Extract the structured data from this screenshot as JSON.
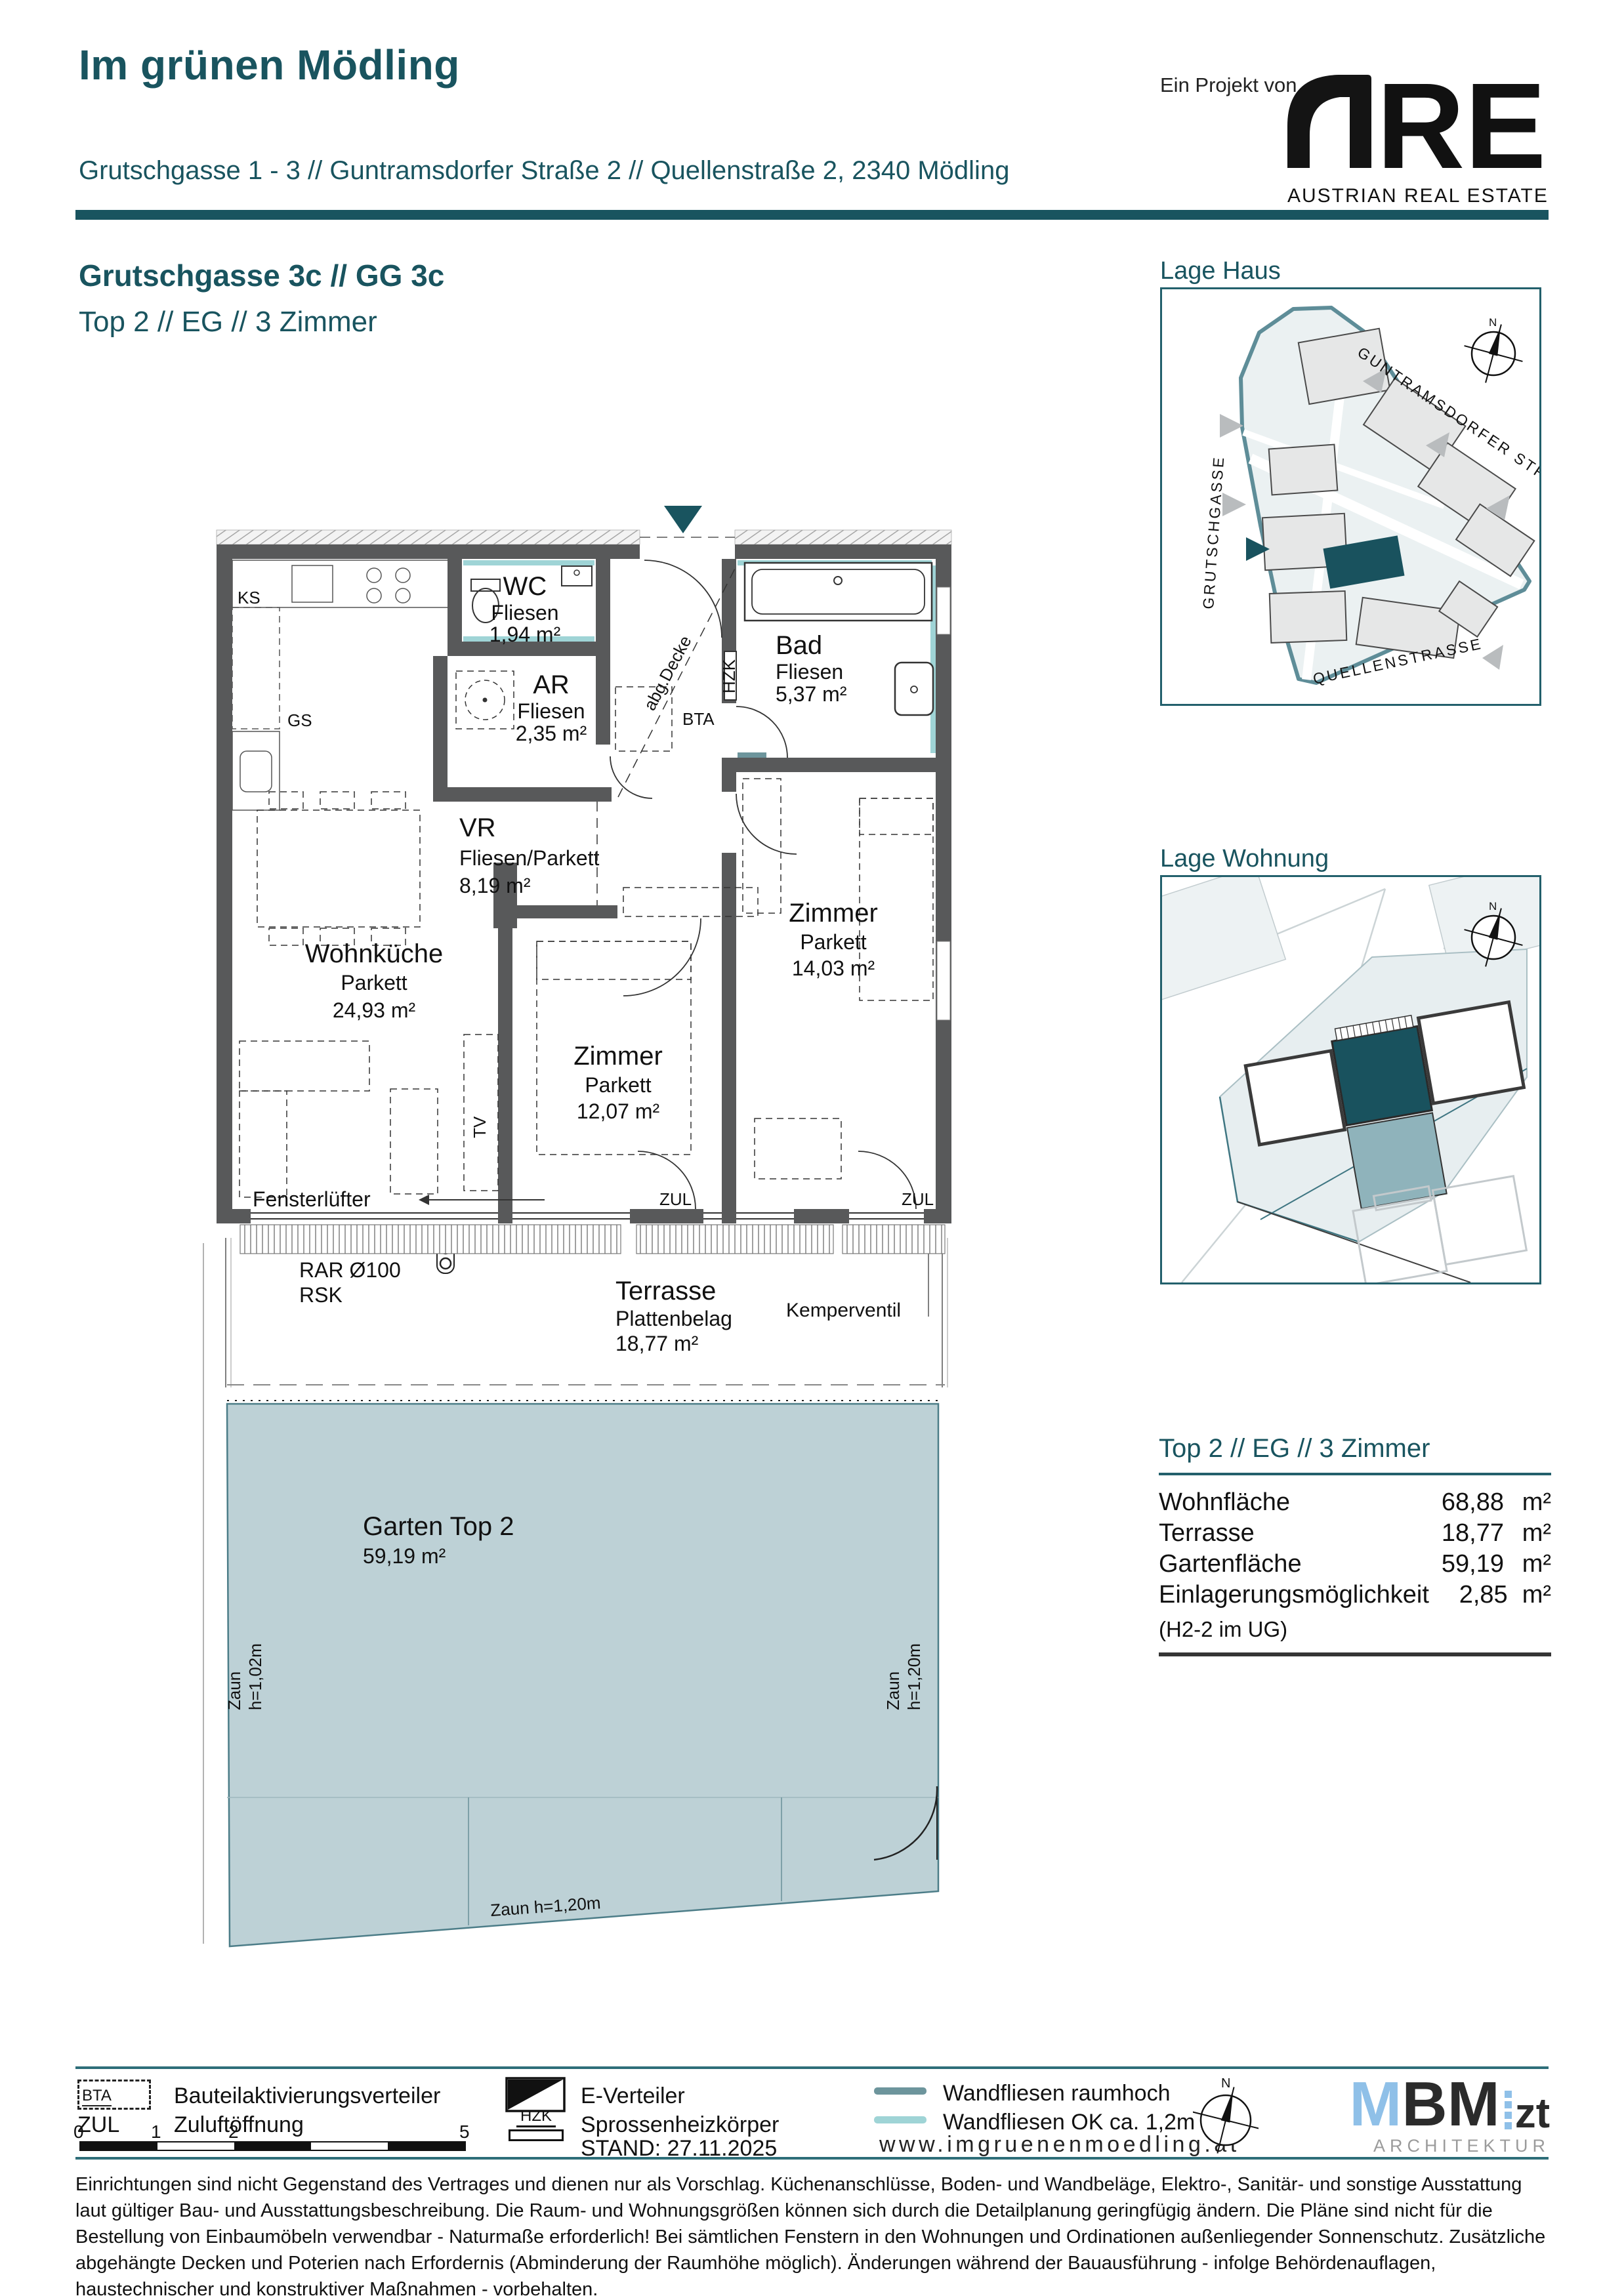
{
  "header": {
    "title": "Im grünen Mödling",
    "address": "Grutschgasse 1 - 3 // Guntramsdorfer Straße 2 // Quellenstraße 2, 2340 Mödling",
    "project_note": "Ein Projekt von",
    "are_logo": {
      "re": "RE",
      "subtitle": "AUSTRIAN REAL ESTATE",
      "green": "#a5c939"
    }
  },
  "section": {
    "building": "Grutschgasse 3c // GG 3c",
    "unit": "Top 2 // EG // 3 Zimmer"
  },
  "plan": {
    "rooms": {
      "wc": {
        "name": "WC",
        "finish": "Fliesen",
        "area": "1,94 m²"
      },
      "ar": {
        "name": "AR",
        "finish": "Fliesen",
        "area": "2,35 m²"
      },
      "bad": {
        "name": "Bad",
        "finish": "Fliesen",
        "area": "5,37 m²"
      },
      "vr": {
        "name": "VR",
        "finish": "Fliesen/Parkett",
        "area": "8,19 m²"
      },
      "wohnkueche": {
        "name": "Wohnküche",
        "finish": "Parkett",
        "area": "24,93 m²"
      },
      "zimmer1": {
        "name": "Zimmer",
        "finish": "Parkett",
        "area": "12,07 m²"
      },
      "zimmer2": {
        "name": "Zimmer",
        "finish": "Parkett",
        "area": "14,03 m²"
      },
      "terrasse": {
        "name": "Terrasse",
        "finish": "Plattenbelag",
        "area": "18,77 m²"
      },
      "garten": {
        "name": "Garten Top 2",
        "area": "59,19 m²"
      }
    },
    "tags": {
      "ks": "KS",
      "gs": "GS",
      "bta": "BTA",
      "hzk": "HZK",
      "tv": "TV",
      "zul1": "ZUL",
      "zul2": "ZUL",
      "abg_decke": "abg.Decke"
    },
    "annotations": {
      "fensterluefter": "Fensterlüfter",
      "rar": "RAR Ø100",
      "rsk": "RSK",
      "kemperventil": "Kemperventil",
      "zaun_left": "Zaun",
      "zaun_left_h": "h=1,02m",
      "zaun_right": "Zaun",
      "zaun_right_h": "h=1,20m",
      "zaun_bottom": "Zaun h=1,20m"
    },
    "colors": {
      "wall": "#58595a",
      "tile_light": "#9fd4d6",
      "tile_dark": "#6d959c",
      "garden_fill": "#bdd1d6",
      "accent": "#19545f"
    }
  },
  "maps": {
    "lage_haus": {
      "title": "Lage Haus",
      "north": "N",
      "streets": {
        "guntramsdorfer": "GUNTRAMSDORFER STRASSE",
        "grutschgasse": "GRUTSCHGASSE",
        "quellenstrasse": "QUELLENSTRASSE"
      }
    },
    "lage_wohnung": {
      "title": "Lage Wohnung",
      "north": "N"
    }
  },
  "summary": {
    "title": "Top 2 // EG // 3 Zimmer",
    "rows": [
      {
        "label": "Wohnfläche",
        "value": "68,88",
        "unit": "m²"
      },
      {
        "label": "Terrasse",
        "value": "18,77",
        "unit": "m²"
      },
      {
        "label": "Gartenfläche",
        "value": "59,19",
        "unit": "m²"
      },
      {
        "label": "Einlagerungsmöglichkeit",
        "value": "2,85",
        "unit": "m²"
      }
    ],
    "note": "(H2-2 im UG)"
  },
  "footer": {
    "legend": {
      "bta_abbr": "BTA",
      "bta": "Bauteilaktivierungsverteiler",
      "zul_abbr": "ZUL",
      "zul": "Zuluftöffnung",
      "e_verteiler": "E-Verteiler",
      "hzk_abbr": "HZK",
      "hzk": "Sprossenheizkörper",
      "tiles_full": "Wandfliesen raumhoch",
      "tiles_half": "Wandfliesen OK ca. 1,2m"
    },
    "scale": {
      "t0": "0",
      "t1": "1",
      "t2": "2",
      "t5": "5"
    },
    "stand": "STAND: 27.11.2025",
    "website": "www.imgruenenmoedling.at",
    "north": "N",
    "mbm": {
      "m": "M",
      "bm": "BM",
      "zt": "zt",
      "sub": "ARCHITEKTUR"
    }
  },
  "disclaimer": "Einrichtungen sind nicht Gegenstand des Vertrages und dienen nur als Vorschlag. Küchenanschlüsse, Boden- und Wandbeläge, Elektro-, Sanitär- und sonstige Ausstattung laut gültiger Bau- und Ausstattungsbeschreibung. Die Raum- und Wohnungsgrößen können sich durch die Detailplanung geringfügig ändern. Die Pläne sind nicht für die Bestellung von Einbaumöbeln verwendbar - Naturmaße erforderlich! Bei sämtlichen Fenstern in den Wohnungen und Ordinationen außenliegender Sonnenschutz. Zusätzliche abgehängte Decken und Poterien nach Erfordernis (Abminderung der Raumhöhe möglich). Änderungen während der Bauausführung - infolge Behördenauflagen, haustechnischer und konstruktiver Maßnahmen - vorbehalten."
}
